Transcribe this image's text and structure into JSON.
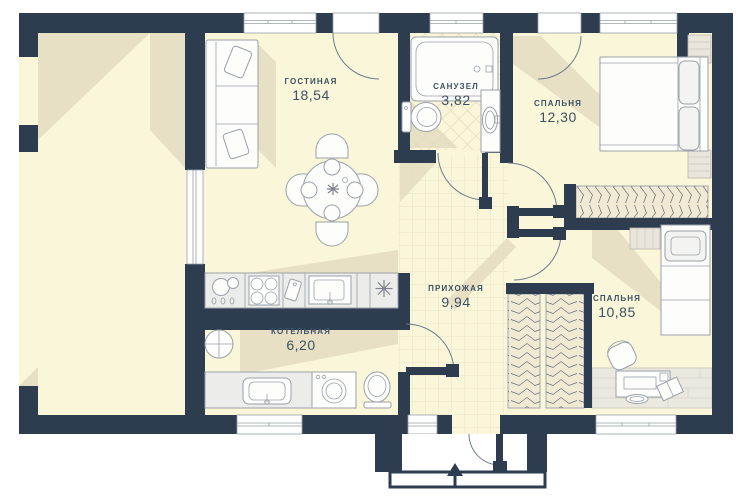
{
  "rooms": [
    {
      "id": "living",
      "name": "ГОСТИНАЯ",
      "area": "18,54"
    },
    {
      "id": "bathroom",
      "name": "САНУЗЕЛ",
      "area": "3,82"
    },
    {
      "id": "bedroom1",
      "name": "СПАЛЬНЯ",
      "area": "12,30"
    },
    {
      "id": "hallway",
      "name": "ПРИХОЖАЯ",
      "area": "9,94"
    },
    {
      "id": "boiler",
      "name": "КОТЕЛЬНАЯ",
      "area": "6,20"
    },
    {
      "id": "bedroom2",
      "name": "СПАЛЬНЯ",
      "area": "10,85"
    }
  ],
  "icons": {
    "entrance_arrow": "▲",
    "heater_asterisk": "✳",
    "boiler_unit": "boiler-circle"
  },
  "colors": {
    "wall": "#2e3c50",
    "floor": "#faf6da",
    "shadow": "#e2dbbf",
    "tile_line": "#eae3c6",
    "furniture_fill": "#ececea",
    "furniture_stroke": "#9aa1a9",
    "wood": "#e9e5db",
    "arc": "#6e7b8a",
    "text": "#3d5064"
  }
}
